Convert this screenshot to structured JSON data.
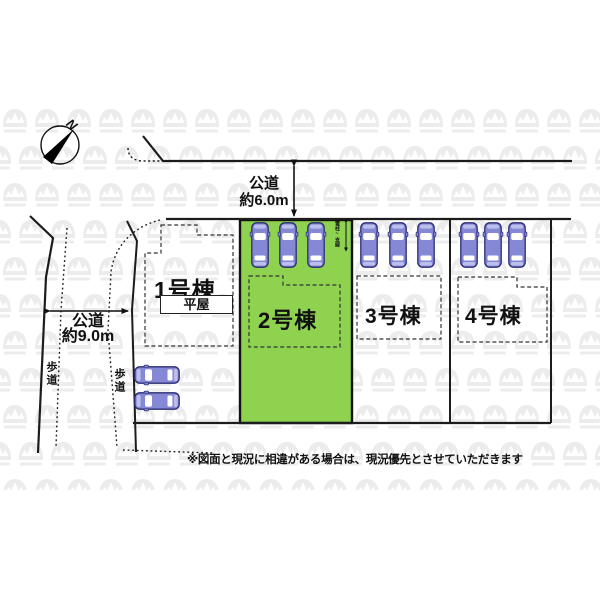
{
  "site_plan": {
    "compass": {
      "label": "N"
    },
    "roads": [
      {
        "id": "north-road",
        "name_label": "公道",
        "size_label": "約6.0m"
      },
      {
        "id": "west-road",
        "name_label": "公道",
        "size_label": "約9.0m"
      }
    ],
    "sidewalks": [
      {
        "label": "歩道"
      },
      {
        "label": "歩道"
      }
    ],
    "lots": [
      {
        "label": "1号棟",
        "note": "平屋",
        "highlighted": false
      },
      {
        "label": "2号棟",
        "highlighted": true
      },
      {
        "label": "3号棟",
        "highlighted": false
      },
      {
        "label": "4号棟",
        "highlighted": false
      }
    ],
    "parking": {
      "cars_lot2": 3,
      "cars_lot3": 3,
      "cars_lot4": 3,
      "cars_lot1": 2
    },
    "utility_note": "電柱~支線",
    "disclaimer": "※図面と現況に相違がある場合は、現況優先とさせていただきます",
    "colors": {
      "highlight_green": "#8ed24f",
      "car_body": "#8588d4",
      "car_outline": "#2b2d72",
      "line": "#1c1c1c",
      "watermark": "#ececec"
    }
  }
}
